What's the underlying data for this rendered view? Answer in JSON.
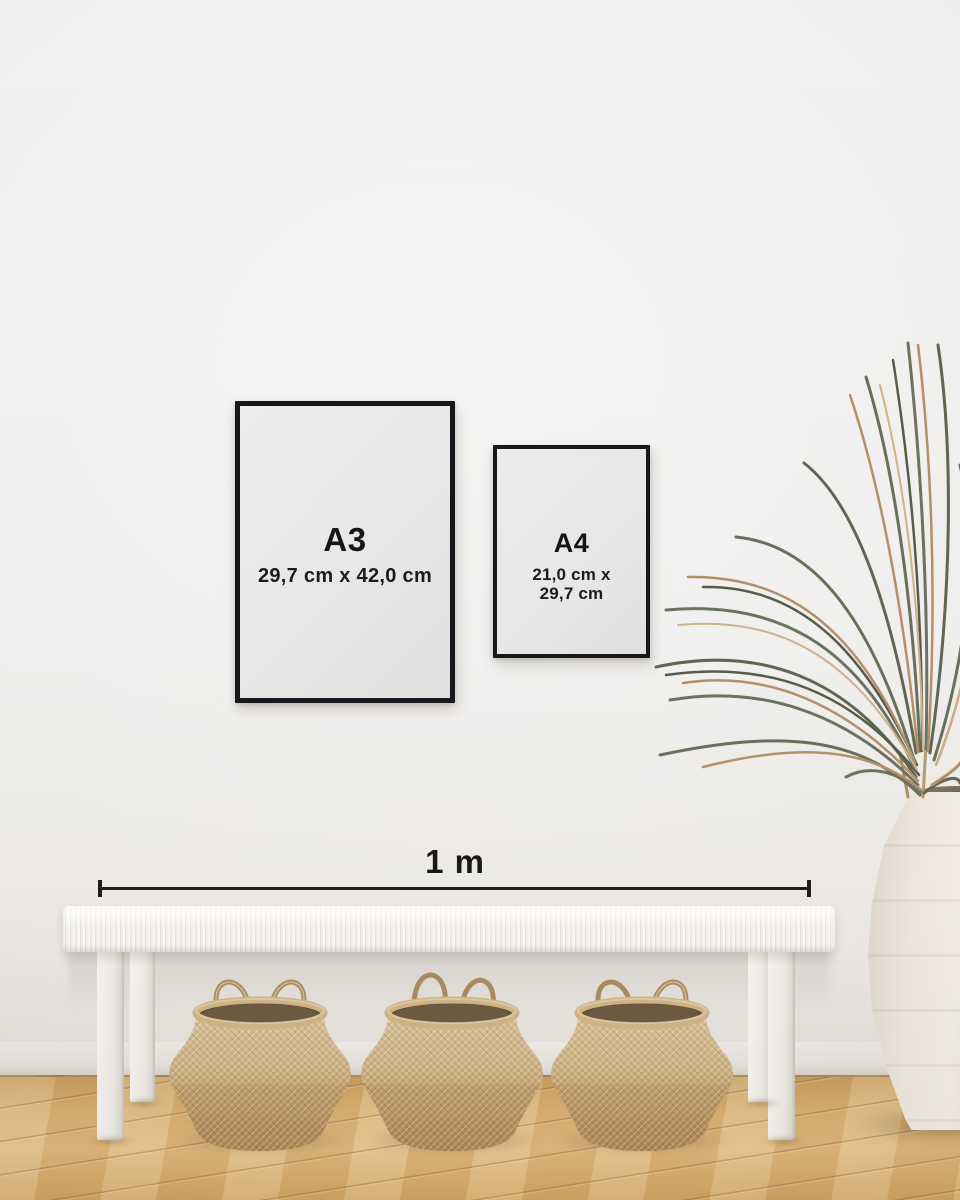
{
  "posters": {
    "a3": {
      "label": "A3",
      "dimensions": "29,7 cm x 42,0 cm"
    },
    "a4": {
      "label": "A4",
      "dimensions_line1": "21,0 cm x",
      "dimensions_line2": "29,7 cm"
    }
  },
  "scale_bar": {
    "label": "1 m"
  },
  "objects": {
    "bench": "white woven bench",
    "basket_count": 3,
    "vase": "cream ceramic floor vase",
    "plant": "dried palm fronds"
  },
  "colors": {
    "wall": "#f0efee",
    "frame": "#17181c",
    "poster_paper": "#e9e7e6",
    "text": "#1a1a1a",
    "floor_wood": "#d9b276",
    "basket_tan": "#c5a471",
    "bench_white": "#f2efeb",
    "plant_green": "#67705b",
    "plant_tan": "#b49069",
    "vase_cream": "#ece6dd"
  }
}
